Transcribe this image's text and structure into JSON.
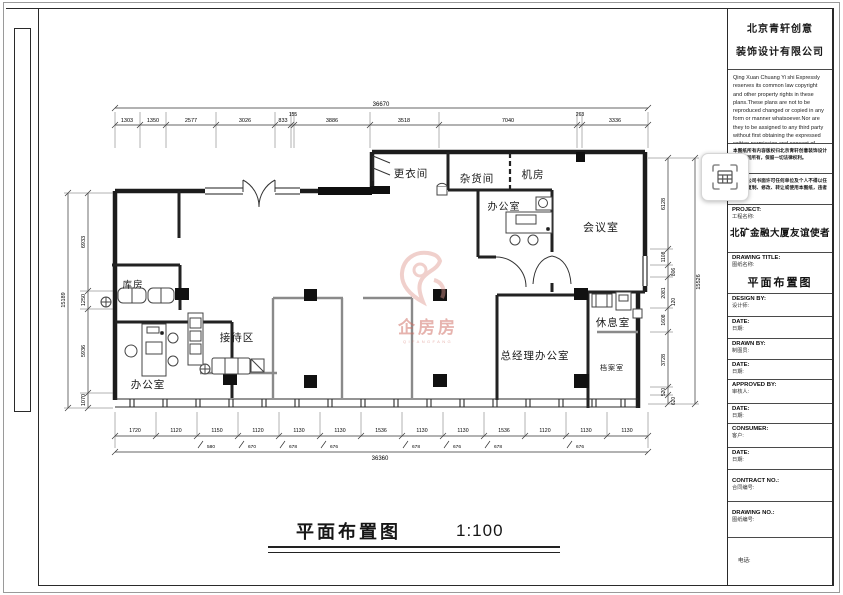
{
  "plan": {
    "rooms": [
      {
        "label": "更衣间"
      },
      {
        "label": "杂货间"
      },
      {
        "label": "机房"
      },
      {
        "label": "办公室"
      },
      {
        "label": "会议室"
      },
      {
        "label": "休息室"
      },
      {
        "label": "总经理办公室"
      },
      {
        "label": "档案室"
      },
      {
        "label": "接待区"
      },
      {
        "label": "库房"
      },
      {
        "label": "办公室"
      }
    ]
  },
  "title": {
    "text": "平面布置图",
    "scale": "1:100"
  },
  "watermark": {
    "text": "企房房",
    "subtext": "QIFANGFANG"
  },
  "dimensions": {
    "top_overall": "36670",
    "top_chain": [
      "1303",
      "1350",
      "2577",
      "3026",
      "833",
      "155",
      "3886",
      "3518",
      "7040",
      "263",
      "3336"
    ],
    "bottom_overall": "36360",
    "bottom_chain": [
      "1720",
      "1120",
      "1150",
      "1120",
      "1130",
      "1130",
      "1536",
      "1130",
      "1130",
      "1536",
      "1120",
      "1130",
      "1130"
    ],
    "bottom_sub": [
      "580",
      "670",
      "678",
      "676",
      "678",
      "676",
      "678",
      "676"
    ],
    "left_chain": [
      "6933",
      "1250",
      "5936",
      "1070"
    ],
    "left_overall": "15189",
    "right_chain": [
      "6128",
      "1108",
      "806",
      "2081",
      "120",
      "1608",
      "3728",
      "520",
      "620"
    ],
    "right_overall": "15526"
  },
  "titleblock": {
    "company_line1": "北京青轩创意",
    "company_line2": "装饰设计有限公司",
    "copyright_en": "Qing Xuan Chuang Yi shi Expressly reserves its common law copyright and other property rights in these plans.These plans are not to be reproduced changed or copied in any form or manner whatsoever.Nor are they to be assigned to any third party without first obtaining the expressed written permission and consent of Zhong Tian Kai Yuan",
    "note1": "本图纸所有内容版权归北京青轩创意装饰设计有限公司所有，保留一切法律权利。",
    "note2": "未经本公司书面许可任何单位及个人不得以任何方式复制、修改、转让或使用本图纸，违者必究。",
    "fields": [
      {
        "en": "PROJECT:",
        "zh": "工程名称:",
        "value": "北矿金融大厦友谊使者"
      },
      {
        "en": "DRAWING TITLE:",
        "zh": "图纸名称:",
        "value": "平面布置图"
      },
      {
        "en": "DESIGN BY:",
        "zh": "设计师:",
        "value": ""
      },
      {
        "en": "DATE:",
        "zh": "日期:",
        "value": ""
      },
      {
        "en": "DRAWN BY:",
        "zh": "制图员:",
        "value": ""
      },
      {
        "en": "DATE:",
        "zh": "日期:",
        "value": ""
      },
      {
        "en": "APPROVED BY:",
        "zh": "审核人:",
        "value": ""
      },
      {
        "en": "DATE:",
        "zh": "日期:",
        "value": ""
      },
      {
        "en": "CONSUMER:",
        "zh": "客户:",
        "value": ""
      },
      {
        "en": "DATE:",
        "zh": "日期:",
        "value": ""
      },
      {
        "en": "CONTRACT NO.:",
        "zh": "合同编号:",
        "value": ""
      },
      {
        "en": "DRAWING NO.:",
        "zh": "图纸编号:",
        "value": ""
      }
    ],
    "phone_label": "电话:"
  }
}
